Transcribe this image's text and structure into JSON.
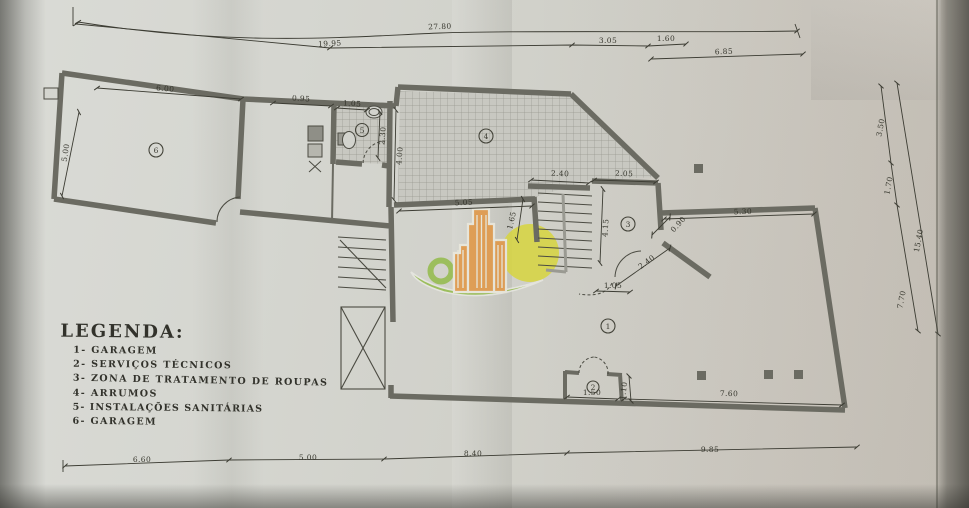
{
  "legend": {
    "title": "LEGENDA:",
    "items": [
      "1-  GARAGEM",
      "2-  SERVIÇOS TÉCNICOS",
      "3-  ZONA DE TRATAMENTO DE ROUPAS",
      "4-  ARRUMOS",
      "5-  INSTALAÇÕES SANITÁRIAS",
      "6-  GARAGEM"
    ]
  },
  "rooms": [
    "1",
    "2",
    "3",
    "4",
    "5",
    "6"
  ],
  "dims": {
    "top_outer": "27.80",
    "top_inner": "19.95",
    "top_a": "3.05",
    "top_b": "1.60",
    "top_c": "6.85",
    "room6_w": "6.00",
    "room6_h": "5.00",
    "corridor_w": "0.95",
    "bath_w": "1.05",
    "bath_h": "2.30",
    "store_h": "4.00",
    "mid_w": "5.05",
    "stairs_w": "2.40",
    "room3_w": "2.05",
    "room3_h": "4.15",
    "room3_diag": "2.40",
    "gap_diag": "0.90",
    "room3_door": "1.05",
    "wall_h": "1.65",
    "room1_top": "5.30",
    "room1_bottom": "7.60",
    "room2_w": "1.50",
    "room2_h": "1.10",
    "right_a": "3.50",
    "right_b": "1.70",
    "right_c": "15.40",
    "right_d": "7.70",
    "bottom_a": "6.60",
    "bottom_b": "5.00",
    "bottom_c": "8.40",
    "bottom_d": "9.85"
  },
  "logo": {
    "orange": "#e2943f",
    "yellow": "#d8d63c",
    "green": "#92ba47"
  }
}
